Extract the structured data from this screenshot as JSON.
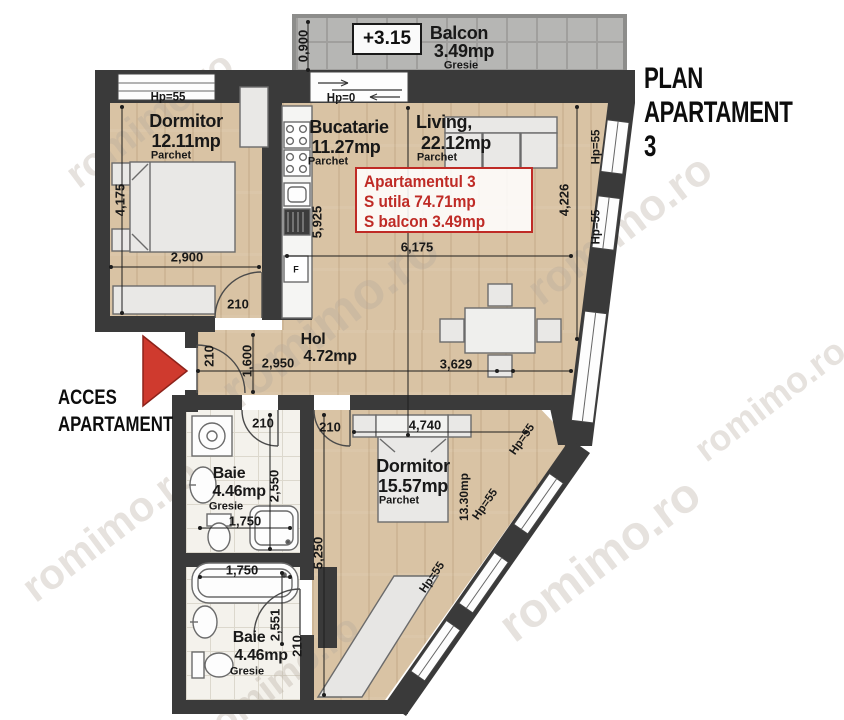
{
  "watermark": "romimo.ro",
  "title": {
    "line1": "PLAN",
    "line2": "APARTAMENT",
    "line3": "3"
  },
  "access": {
    "line1": "ACCES",
    "line2": "APARTAMENT"
  },
  "balcony": {
    "name": "Balcon",
    "area": "3.49mp",
    "floor": "Gresie",
    "elevation": "+3.15"
  },
  "info_box": {
    "title": "Apartamentul 3",
    "utila": "S utila 74.71mp",
    "balcon": "S balcon 3.49mp"
  },
  "rooms": {
    "dormitor1": {
      "name": "Dormitor",
      "area": "12.11mp",
      "floor": "Parchet"
    },
    "bucatarie": {
      "name": "Bucatarie",
      "area": "11.27mp",
      "floor": "Parchet"
    },
    "living": {
      "name": "Living,",
      "area": "22.12mp",
      "floor": "Parchet"
    },
    "hol": {
      "name": "Hol",
      "area": "4.72mp"
    },
    "baie1": {
      "name": "Baie",
      "area": "4.46mp",
      "floor": "Gresie"
    },
    "dormitor2": {
      "name": "Dormitor",
      "area": "15.57mp",
      "floor": "Parchet"
    },
    "baie2": {
      "name": "Baie",
      "area": "4.46mp",
      "floor": "Gresie"
    }
  },
  "appliances": {
    "fridge_label": "F"
  },
  "dims": {
    "door": "210",
    "hp55": "Hp=55",
    "hp0": "Hp=0",
    "d0900": "0,900",
    "d4175": "4,175",
    "d2900": "2,900",
    "d5925": "5,925",
    "d6175": "6,175",
    "d4226": "4,226",
    "d2950": "2,950",
    "d1600": "1,600",
    "d3629": "3,629",
    "d2550": "2,550",
    "d1750": "1,750",
    "d5250": "5,250",
    "d2551": "2,551",
    "d4740": "4,740",
    "d1330": "13.30mp"
  }
}
